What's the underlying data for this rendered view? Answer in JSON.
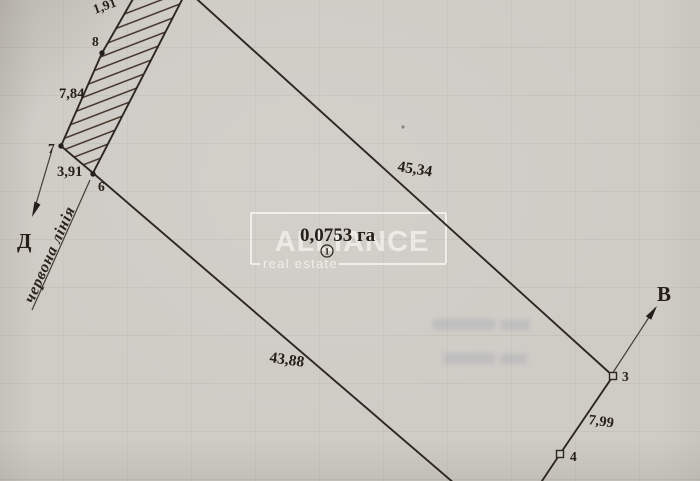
{
  "watermark": {
    "title": "ALLIANCE",
    "subtitle": "real estate"
  },
  "area": {
    "value": "0,0753 га",
    "index": "1"
  },
  "red_line": {
    "label": "червона лінія"
  },
  "directions": {
    "west": "Д",
    "east": "В"
  },
  "points": {
    "p3": "3",
    "p4": "4",
    "p6": "6",
    "p7": "7",
    "p8": "8"
  },
  "measurements": {
    "top_segment": "1,91",
    "seg_8_7": "7,84",
    "seg_7_6": "3,91",
    "boundary_ne": "45,34",
    "boundary_sw": "43,88",
    "seg_3_4": "7,99"
  }
}
